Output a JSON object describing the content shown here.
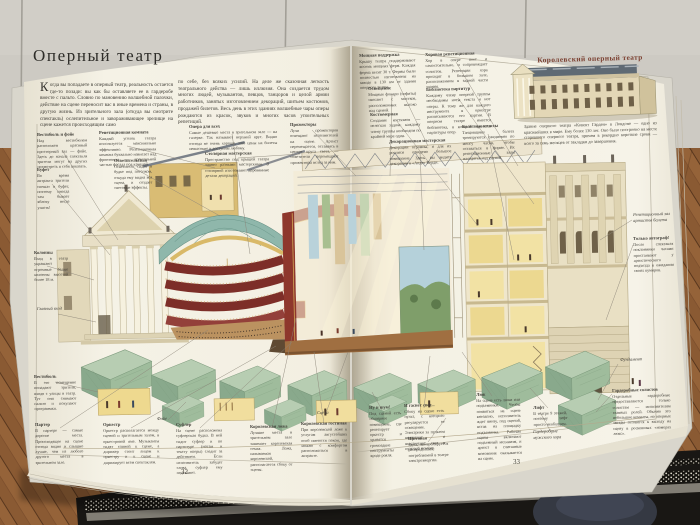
{
  "photo_context": {
    "surface": "wooden plank floor",
    "wall": "grey concrete wall with seams",
    "rug": "dark knitted rug with white and grey stripes",
    "object": "dark slipper"
  },
  "colors": {
    "page_cream": "#f4f1e4",
    "heading_red": "#7c4132",
    "tiers_maroon": "#7d2e28",
    "dome_teal": "#8fb7ab",
    "foundation_green": "#9dbb98",
    "wood_floor": "#8a5a33",
    "rug_dark": "#191714"
  },
  "book": {
    "left_page": {
      "page_number": "32",
      "title": "Оперный театр",
      "intro": {
        "dropcap": "К",
        "col1": "огда вы попадаете в оперный театр, реальность остается где-то позади: вы как бы оставляете ее в гардеробе вместе с пальто. Словно по мановению волшебной палочки, действие на сцене переносит вас в иные времена и страны, в другую жизнь. Из зрительного зала (откуда вы смотрите спектакль) ослепительное и завораживающее зрелище на сцене кажется происходящим само",
        "col2": "по себе, без всяких усилий. На деле же сказочная легкость театрального действа — лишь иллюзия. Она создается трудом многих людей, музыкантов, певцов, танцоров и целой армии работников, занятых изготовлением декораций, шитьем костюмов, продажей билетов. Весь день в этих зданиях волшебные чары оперы рождаются из красок, звуков и многих часов упоительных репетиций."
      },
      "labels": [
        {
          "id": "label-vestibule-foyer",
          "title": "Вестибюль и фойе",
          "text": "Над вестибюлем расположен красивый просторный зал — фойе. Здесь до начала спектакля зрители могут на других посмотреть и себя показать.",
          "x": 37,
          "y": 132,
          "w": 50
        },
        {
          "id": "label-rehearsal-room",
          "title": "Репетиционная комната",
          "text": "Каждый уголок театра используется максимально эффективно. Репетиционная комната буквально нависает над фронтоном — треугольной частью фасада под крышей.",
          "x": 99,
          "y": 130,
          "w": 57
        },
        {
          "id": "label-buffet",
          "title": "Буфет",
          "text": "Во время антракта зрители спешат в буфет, поэтому иногда там бывает яблоку негде упасть!",
          "x": 37,
          "y": 167,
          "w": 32
        },
        {
          "id": "label-lighting-box",
          "title": "Осветительская",
          "text": "Осветитель сидит в будке под потолком, откуда ему видна вся сцена, и создает световые эффекты.",
          "x": 114,
          "y": 158,
          "w": 38
        },
        {
          "id": "label-columns",
          "title": "Колонны",
          "text": "Вход в театр украшают огромные белые колонны высотой более 18 м.",
          "x": 34,
          "y": 250,
          "w": 34
        },
        {
          "id": "label-main-entrance",
          "title": "Главный вход",
          "italic": true,
          "text": "",
          "x": 37,
          "y": 306,
          "w": 26
        },
        {
          "id": "label-vestibule",
          "title": "Вестибюль",
          "text": "В это помещение попадают зрители, входя с улицы в театр. Тут они снимают пальто и покупают программки.",
          "x": 34,
          "y": 374,
          "w": 42
        },
        {
          "id": "label-parterre",
          "title": "Партер",
          "text": "В партере — самые дорогие места. Происходящее на сцене отсюда видно и слышно лучше, чем из любого другого места в зрительном зале.",
          "x": 35,
          "y": 422,
          "w": 48
        },
        {
          "id": "label-orchestra",
          "title": "Оркестр",
          "text": "Оркестр располагается между сценой и зрительным залом, в оркестровой яме. Музыканты сидят спиной к сцене, а дирижер стоит лицом к оркестру и к сцене и дирижирует всем спектаклем.",
          "x": 103,
          "y": 422,
          "w": 56
        },
        {
          "id": "label-prompter",
          "title": "Суфлер",
          "text": "На сцене расположена суфлерская будка. В ней сидит суфлер и по партитуре (нотам и тексту оперы) следит за действием. Если исполнитель забудет слова, суфлер ему подскажет.",
          "x": 176,
          "y": 422,
          "w": 46
        },
        {
          "id": "label-opera-for-all",
          "title": "Опера для всех",
          "text": "Самые дешевые места в зрительном зале — на галерке. Так называют верхний ярус. Видно отсюда не очень хорошо, зато цены на билеты невысокие и доступны любому.",
          "x": 189,
          "y": 124,
          "w": 88
        },
        {
          "id": "label-spotlights",
          "title": "Прожекторы",
          "text": "Лучи прожекторов освещают исполнителей на сцене. Артист перемещается, оставаясь в центре круга света, — осветители перемещают прожекторы вслед за ним.",
          "x": 290,
          "y": 122,
          "w": 48
        },
        {
          "id": "label-carpentry-workshop",
          "title": "Столярная мастерская",
          "text": "Пространство под крышей театра занято разными мастерскими. В столярной изготовляют деревянные детали декораций.",
          "x": 205,
          "y": 151,
          "w": 64
        },
        {
          "id": "label-foyer",
          "title": "Фойе",
          "italic": true,
          "text": "",
          "x": 157,
          "y": 416,
          "w": 22
        },
        {
          "id": "label-stage",
          "title": "Сцена",
          "italic": true,
          "text": "",
          "x": 317,
          "y": 410,
          "w": 24
        },
        {
          "id": "label-royal-box",
          "title": "Королевская ложа",
          "text": "Лучшие места в зрительном зале занимает королевская семья. Ложа, называемая королевской, располагается сбоку от сцены.",
          "x": 250,
          "y": 424,
          "w": 42
        },
        {
          "id": "label-royal-lounge",
          "title": "Королевская гостиная",
          "text": "При королевской ложе к услугам августейших особ имеются покои, где можно с комфортом расположиться в антракте.",
          "x": 301,
          "y": 421,
          "w": 46
        }
      ]
    },
    "right_page": {
      "page_number": "33",
      "sidebar": {
        "title": "Королевский оперный театр",
        "caption": "Здание оперного театра «Ковент Гарден» в Лондоне — одно из красивейших в мире. Ему более 130 лет. Оно было построено на месте сгоревшего оперного театра, причем в рекордно короткие сроки — всего за семь месяцев от закладки до завершения."
      },
      "labels": [
        {
          "id": "label-strong-support",
          "title": "Мощная поддержка",
          "text": "Крышу театра поддерживают восемь мощных ферм. Каждая ферма весит 30 т. Фермы были полностью изготовлены на заводе в 130 км от здания оперного театра.",
          "x": 359,
          "y": 53,
          "w": 56
        },
        {
          "id": "label-choir-rehearsal",
          "title": "Хоровая репетиционная",
          "text": "Хор в опере поет и самостоятельно, и сопровождает солистов. Репетиции хора проходят в большом зале, расположенном в задней части здания.",
          "x": 425,
          "y": 52,
          "w": 62
        },
        {
          "id": "label-stage-lighting",
          "title": "Освещение",
          "text": "Мощные фонари (софиты) свисают с мостков, расположенных высоко над сценой.",
          "x": 368,
          "y": 86,
          "w": 48
        },
        {
          "id": "label-score-library",
          "title": "Библиотека партитур",
          "text": "Каждому члену оперной труппы необходимы ноты текста и нот оперы. К тому же для каждого инструмента в оркестре расписываются его партии. В оперном театре имеется библиотека, в которой хранятся партитуры опер.",
          "x": 426,
          "y": 87,
          "w": 64
        },
        {
          "id": "label-costume-room",
          "title": "Костюмерная",
          "text": "Создание костюмов — нелегкая задача: каждому члену труппы необходим по крайней мере один.",
          "x": 370,
          "y": 112,
          "w": 50
        },
        {
          "id": "label-ballet-classes",
          "title": "Балетные классы",
          "text": "Танцовщики балета тренируются ежедневно по многу часов, чтобы оставаться в форме. Их репетиционные залы находятся над сценой.",
          "x": 462,
          "y": 124,
          "w": 52
        },
        {
          "id": "label-scenery-workshop",
          "title": "Декорационная мастерская",
          "text": "Декорации огромны, и для их росписи отведено большое помещение. Здесь вы видите декорации к «Аиде» Верди.",
          "x": 389,
          "y": 139,
          "w": 62
        },
        {
          "id": "label-noise",
          "title": "Ну и шум!",
          "text": "Под сценой есть обширное помещение, где репетирует оркестр и хранятся громоздкие инструменты вроде рояля.",
          "x": 369,
          "y": 405,
          "w": 32
        },
        {
          "id": "label-lights-out",
          "title": "И гаснет свет...",
          "text": "Сбоку на сцене есть пульт, с которого регулируется ее освещение. Электрики за пультом включают и выключают свет в нужный момент.",
          "x": 404,
          "y": 403,
          "w": 40
        },
        {
          "id": "label-switchboard",
          "title": "Щитовая",
          "text": "Здесь контролируется распределение потребляемой в театре электроэнергии.",
          "x": 408,
          "y": 436,
          "w": 40
        },
        {
          "id": "label-trapdoor",
          "title": "Люк",
          "text": "На сцене есть люки или подъемники. Чтобы появиться на сцене внезапно, исполнитель ждет внизу, под сценой, встав на площадку подъемника. Рабочие сцены включают подъемный механизм, и артист в считанные мгновения оказывается на сцене.",
          "x": 476,
          "y": 392,
          "w": 44
        },
        {
          "id": "label-lift",
          "title": "Лифт",
          "text": "В театре 9 этажей, поэтому лифт просто необходим.",
          "x": 533,
          "y": 405,
          "w": 34
        },
        {
          "id": "label-mens-choir-dressing",
          "title": "Гардеробные мужского хора",
          "italic": true,
          "text": "",
          "x": 533,
          "y": 429,
          "w": 36
        },
        {
          "id": "label-ballet-rehearsal-hall",
          "title": "Репетиционный зал артистов балета",
          "italic": true,
          "text": "",
          "x": 633,
          "y": 212,
          "w": 40
        },
        {
          "id": "label-autograph",
          "title": "Только автограф!",
          "text": "После спектакля поклонники часами простаивают у артистического подъезда в ожидании своих кумиров.",
          "x": 633,
          "y": 236,
          "w": 40
        },
        {
          "id": "label-foundation",
          "title": "Фундамент",
          "italic": true,
          "text": "",
          "x": 620,
          "y": 357,
          "w": 38
        },
        {
          "id": "label-soloists-dressing",
          "title": "Гардеробные солистов",
          "text": "Отдельные гардеробные предоставляются только солистам — исполнителям главных ролей. Обычно это небольшие комнаты, но оперные звезды готовятся к выходу на сцену в роскошных «номерах люкс».",
          "x": 612,
          "y": 388,
          "w": 58
        }
      ]
    }
  }
}
